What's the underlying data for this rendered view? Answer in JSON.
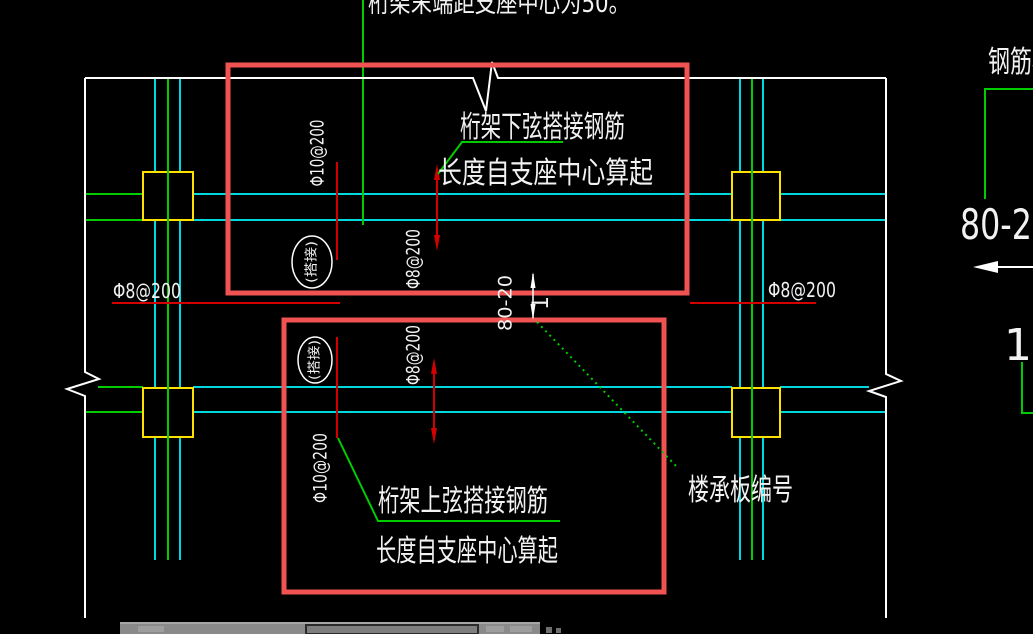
{
  "canvas": {
    "top_note_cut": "桁架末端距支座中心为50。",
    "truss_bottom_chord_note": {
      "line1": "桁架下弦搭接钢筋",
      "line2": "长度自支座中心算起"
    },
    "truss_top_chord_note": {
      "line1": "桁架上弦搭接钢筋",
      "line2": "长度自支座中心算起"
    },
    "deck_number_label": "楼承板编号",
    "rebar_labels": {
      "left_horizontal": "Φ8@200",
      "right_horizontal": "Φ8@200",
      "top_box_phi10": "Φ10@200",
      "top_box_phi8": "Φ8@200",
      "bottom_box_phi8": "Φ8@200",
      "bottom_box_phi10": "Φ10@200",
      "lap_top": "(搭接)",
      "lap_bottom": "(搭接)"
    },
    "dimension": {
      "value": "80-20",
      "index": "1"
    },
    "legend": {
      "truss_text": "钢筋桁架",
      "deck_model": "80-20",
      "mark_number": "1"
    },
    "colors": {
      "background": "#000000",
      "axis_cyan": "#00d8e0",
      "grid_green": "#00cc00",
      "column_yellow": "#ffe100",
      "highlight_red": "#f15252",
      "annotation_red": "#d40000",
      "text_white": "#f2f2f2",
      "taskbar_gray": "#8a8a8a"
    }
  }
}
